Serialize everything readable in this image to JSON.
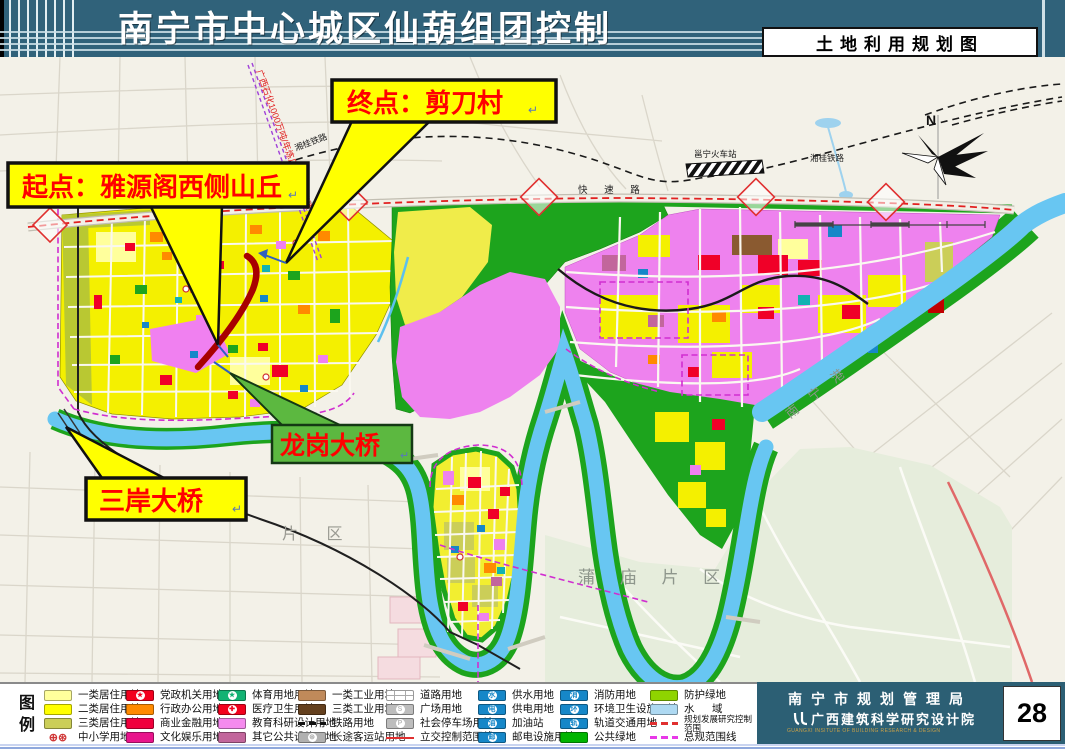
{
  "header": {
    "title": "南宁市中心城区仙葫组团控制规划",
    "map_type_label": "土地利用规划图"
  },
  "map": {
    "callouts": {
      "end_point": "终点：剪刀村",
      "start_point": "起点：雅源阁西侧山丘",
      "longgang_bridge": "龙岗大桥",
      "sanan_bridge": "三岸大桥"
    },
    "labels": {
      "pipeline": "广西石化1000万吨/年炼厂成品油管道",
      "railway_station": "邕宁火车站",
      "railway_left": "湘桂铁路",
      "railway_right": "湘桂铁路",
      "expressway": "快 速 路",
      "port": "南 宁 港",
      "pumiao": "蒲 庙 片 区",
      "district_partial": "片 区",
      "north": "N"
    }
  },
  "legend": {
    "title_chars": "图例",
    "columns": [
      [
        {
          "label": "一类居住用地",
          "type": "fill",
          "color": "#FFFF9C"
        },
        {
          "label": "二类居住用地",
          "type": "fill",
          "color": "#FFFF00"
        },
        {
          "label": "三类居住用地",
          "type": "fill",
          "color": "#CBCE58"
        },
        {
          "label": "中小学用地",
          "type": "icon",
          "glyph": "⊕⊛",
          "color": "#D03838"
        }
      ],
      [
        {
          "label": "党政机关用地",
          "type": "sym",
          "color": "#F2001E",
          "glyph": "★"
        },
        {
          "label": "行政办公用地",
          "type": "fill",
          "color": "#FF8A00"
        },
        {
          "label": "商业金融用地",
          "type": "fill",
          "color": "#F0003C"
        },
        {
          "label": "文化娱乐用地",
          "type": "fill",
          "color": "#E8158C"
        }
      ],
      [
        {
          "label": "体育用地用地",
          "type": "sym",
          "color": "#12B273",
          "glyph": "★"
        },
        {
          "label": "医疗卫生用地",
          "type": "sym",
          "color": "#F2001E",
          "glyph": "✚"
        },
        {
          "label": "教育科研设计用地",
          "type": "fill",
          "color": "#F58AEE"
        },
        {
          "label": "其它公共设施用地",
          "type": "fill",
          "color": "#C2669C"
        }
      ],
      [
        {
          "label": "一类工业用地",
          "type": "fill",
          "color": "#C08A5A"
        },
        {
          "label": "三类工业用地",
          "type": "fill",
          "color": "#64401E"
        },
        {
          "label": "铁路用地",
          "type": "dash",
          "color": "#111111"
        },
        {
          "label": "长途客运站用地",
          "type": "sym",
          "color": "#B0B0B0",
          "glyph": "⊛"
        }
      ],
      [
        {
          "label": "道路用地",
          "type": "road"
        },
        {
          "label": "广场用地",
          "type": "sym",
          "color": "#BDBDBD",
          "glyph": "S"
        },
        {
          "label": "社会停车场用地",
          "type": "sym",
          "color": "#BDBDBD",
          "glyph": "P"
        },
        {
          "label": "立交控制范围线",
          "type": "line",
          "color": "#E03030"
        }
      ],
      [
        {
          "label": "供水用地",
          "type": "sym",
          "color": "#1687C8",
          "glyph": "水"
        },
        {
          "label": "供电用地",
          "type": "sym",
          "color": "#1687C8",
          "glyph": "电"
        },
        {
          "label": "加油站",
          "type": "sym",
          "color": "#1687C8",
          "glyph": "油"
        },
        {
          "label": "邮电设施用地",
          "type": "sym",
          "color": "#1687C8",
          "glyph": "邮"
        }
      ],
      [
        {
          "label": "消防用地",
          "type": "sym",
          "color": "#1687C8",
          "glyph": "消"
        },
        {
          "label": "环境卫生设施用地",
          "type": "sym",
          "color": "#1687C8",
          "glyph": "环"
        },
        {
          "label": "轨道交通用地",
          "type": "sym",
          "color": "#1687C8",
          "glyph": "轨"
        },
        {
          "label": "公共绿地",
          "type": "fill",
          "color": "#00B400"
        }
      ],
      [
        {
          "label": "防护绿地",
          "type": "fill",
          "color": "#8FD400"
        },
        {
          "label": "水      域",
          "type": "fill",
          "color": "#AED9F2"
        },
        {
          "label": "规划发展研究控制范围",
          "type": "dash",
          "color": "#E03030",
          "small": true
        },
        {
          "label": "总规范围线",
          "type": "dash",
          "color": "#E838E8"
        }
      ]
    ]
  },
  "footer": {
    "agency_cn": "南宁市规划管理局",
    "institute_cn": "广西建筑科学研究设计院",
    "institute_en": "GUANGXI INSITUTE OF BUILDING RESEARCH & DESIGN",
    "page_number": "28"
  }
}
